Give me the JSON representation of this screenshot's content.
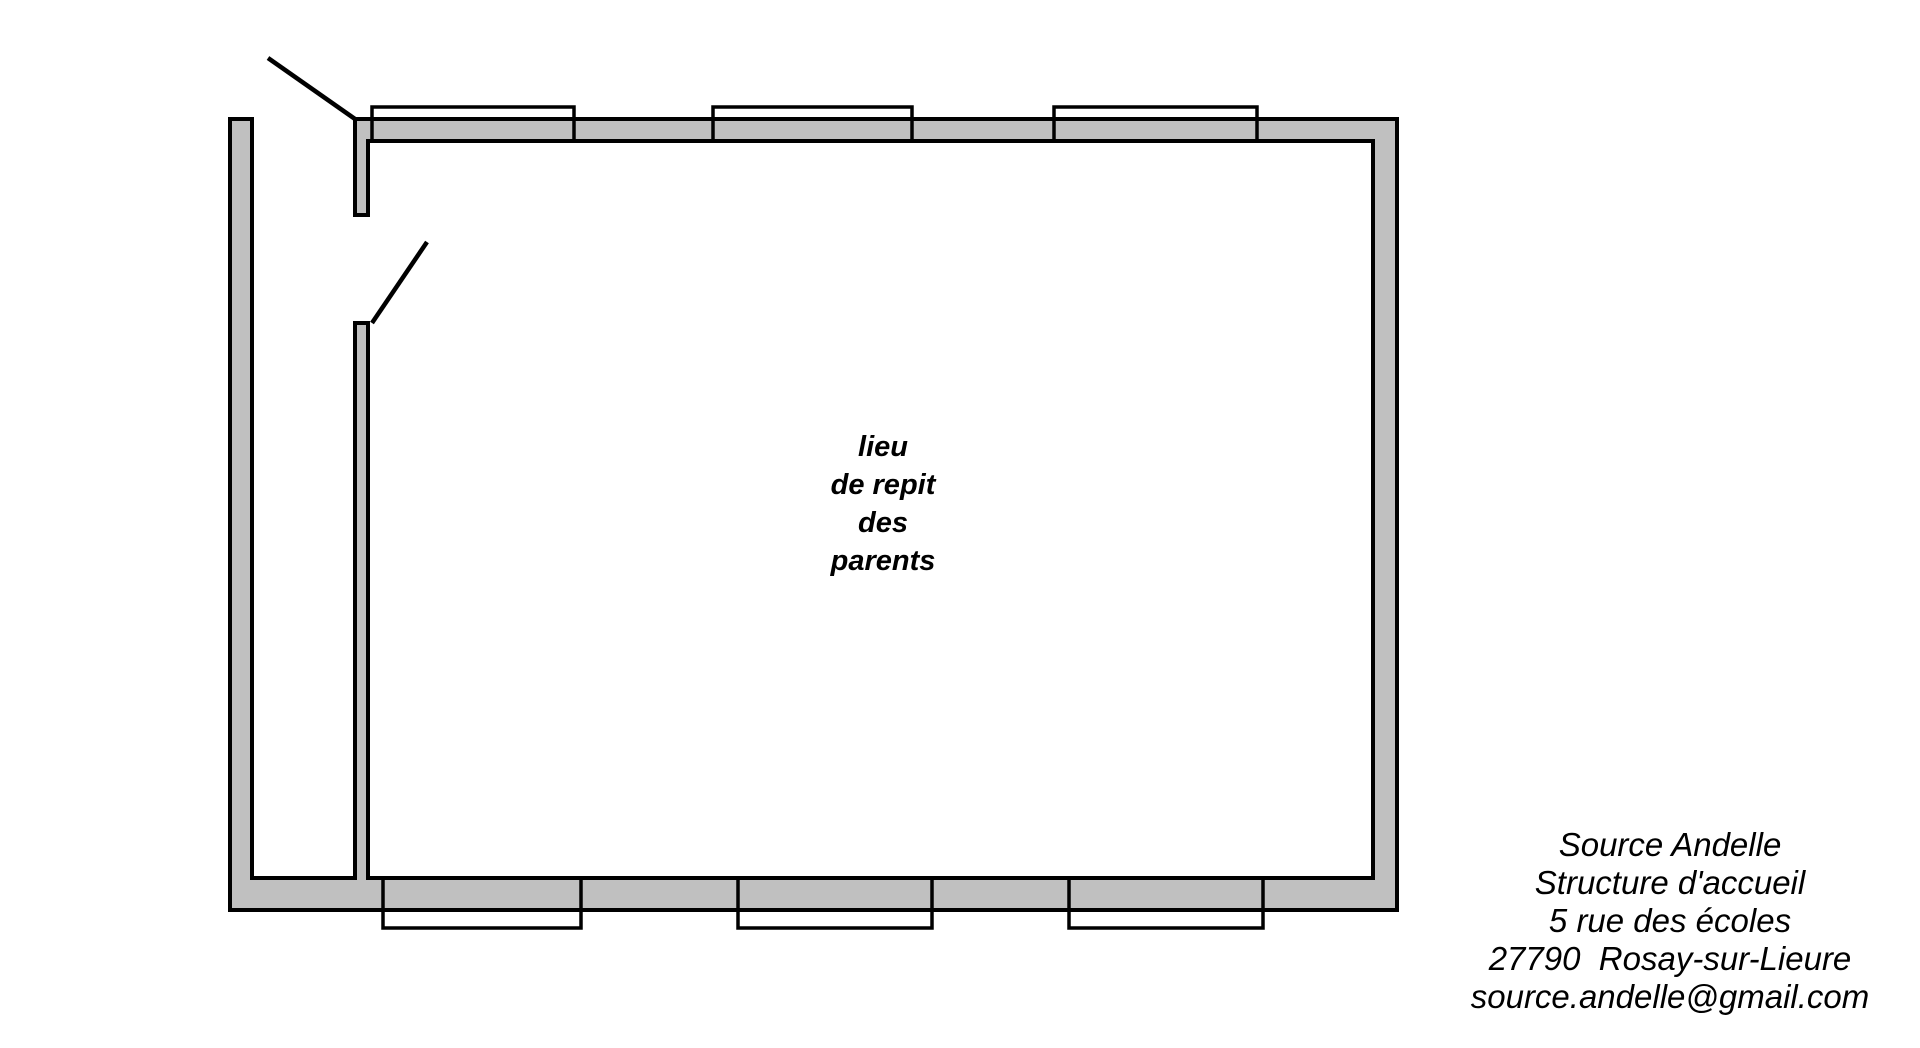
{
  "colors": {
    "wall_fill": "#c0c0c0",
    "outline": "#000000",
    "text": "#000000",
    "page_bg": "#ffffff"
  },
  "room_label": {
    "lines": [
      "lieu",
      "de repit",
      "des",
      "parents"
    ]
  },
  "source_block": {
    "lines": [
      "Source Andelle",
      "Structure d'accueil",
      "5 rue des écoles",
      "27790  Rosay-sur-Lieure",
      "source.andelle@gmail.com"
    ]
  }
}
